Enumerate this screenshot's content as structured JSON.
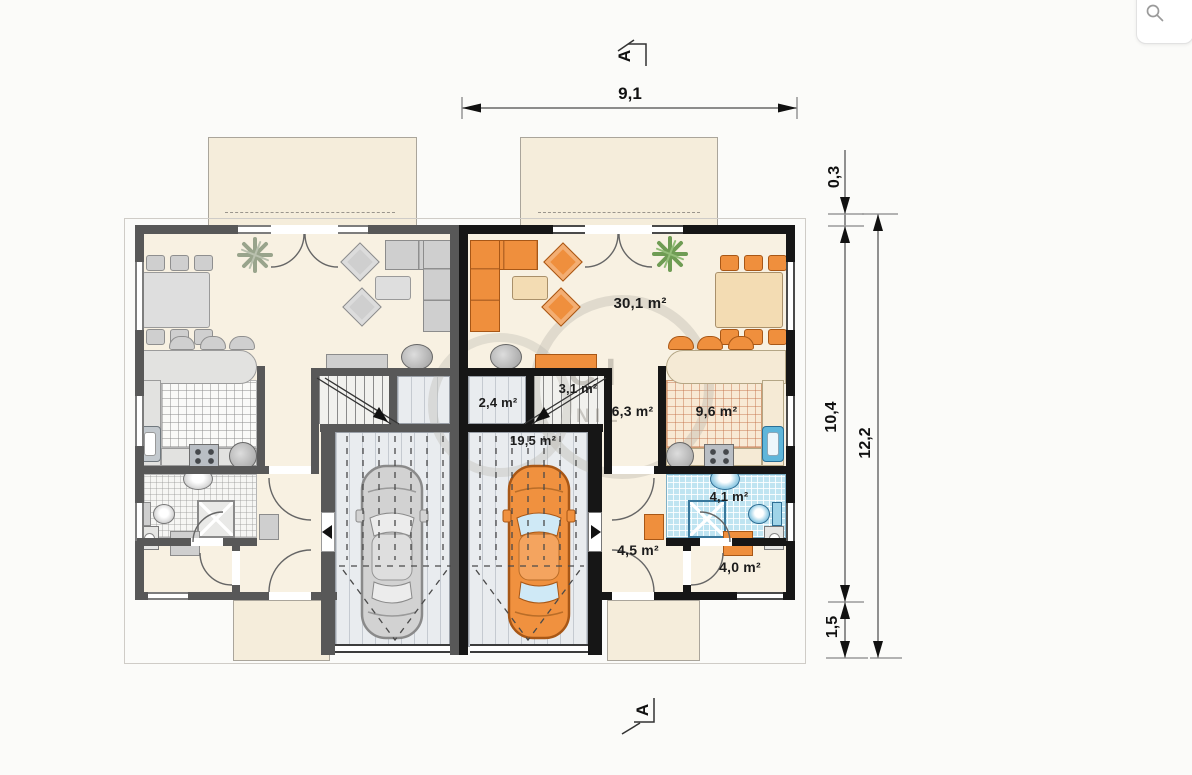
{
  "zoom_control": {
    "icon": "magnifier"
  },
  "section_markers": {
    "top_label": "A",
    "bottom_label": "A"
  },
  "dimensions": {
    "overall_width_top": "9,1",
    "right_wall_thickness": "0,3",
    "right_inner_depth": "10,4",
    "right_front_offset": "1,5",
    "right_overall_depth": "12,2"
  },
  "rooms": {
    "living_room": "30,1 m²",
    "pantry": "2,4 m²",
    "staircase": "3,1 m²",
    "garage": "19,5 m²",
    "hall": "6,3 m²",
    "kitchen": "9,6 m²",
    "bathroom": "4,1 m²",
    "entry_hall": "4,5 m²",
    "utility_room": "4,0 m²"
  },
  "watermark": {
    "line1": "CI",
    "line2": "NIE"
  },
  "colors": {
    "accent_furniture": "#ef8f3d",
    "mirror_unit_furniture": "#cfcfcf",
    "wall_main_unit": "#161616",
    "wall_mirror_unit": "#585858",
    "floor": "#f8f1e2",
    "bath_tiles": "#bfe4f1",
    "terrace": "#f5eddb"
  }
}
